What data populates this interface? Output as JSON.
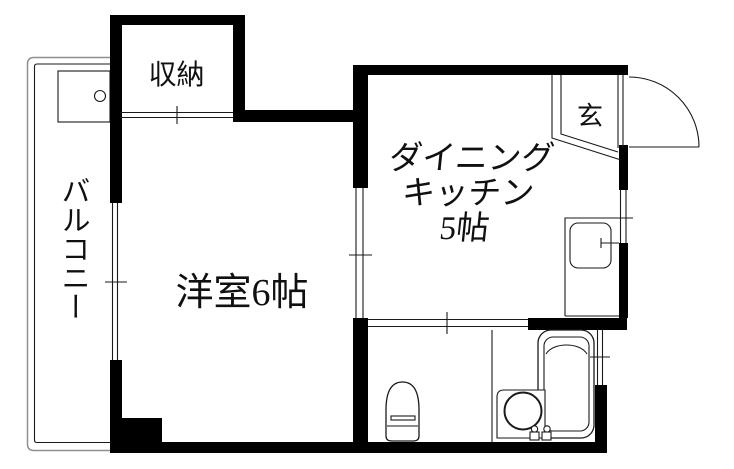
{
  "rooms": {
    "balcony": {
      "label": "バルコニー"
    },
    "closet": {
      "label": "収納"
    },
    "western_room": {
      "label": "洋室6帖",
      "size_tatami": "6"
    },
    "dining_kitchen": {
      "label_lines": [
        "ダイニング",
        "キッチン",
        "5帖"
      ],
      "size_tatami": "5"
    },
    "entrance": {
      "label": "玄"
    }
  },
  "colors": {
    "wall": "#000000",
    "thin_line": "#1a1a1a",
    "outline_gray": "#8f8f8f",
    "background": "#ffffff"
  }
}
